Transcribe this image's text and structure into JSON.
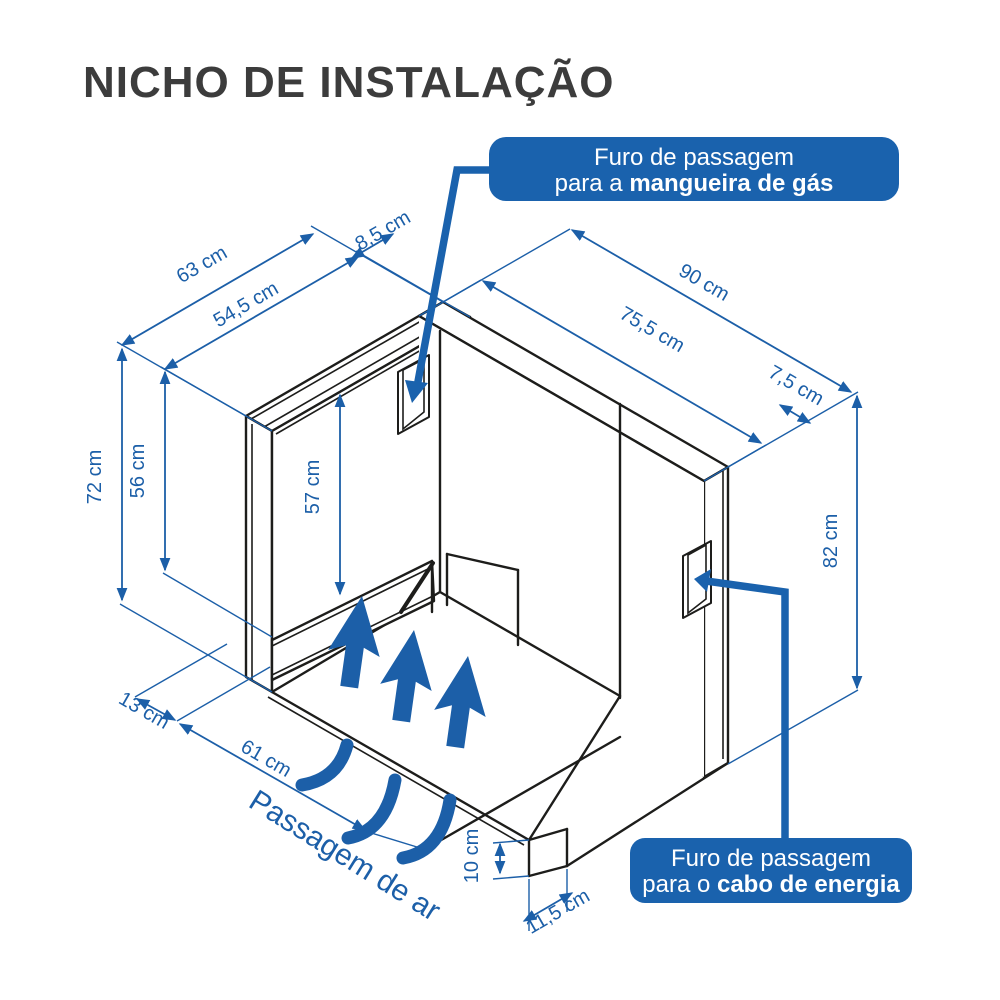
{
  "title": "NICHO DE INSTALAÇÃO",
  "colors": {
    "accent_blue": "#1c5fa8",
    "callout_blue": "#1a62ad",
    "line_black": "#1d1d1b",
    "title_gray": "#3c3c3c",
    "background": "#ffffff"
  },
  "callouts": {
    "gas": {
      "line1": "Furo de passagem",
      "line2_prefix": "para a ",
      "line2_bold": "mangueira de gás"
    },
    "power": {
      "line1": "Furo de passagem",
      "line2_prefix": "para o ",
      "line2_bold": "cabo de energia"
    }
  },
  "air_passage_label": "Passagem de ar",
  "dims": {
    "d63": "63 cm",
    "d545": "54,5 cm",
    "d85": "8,5 cm",
    "d90": "90 cm",
    "d755": "75,5 cm",
    "d75": "7,5 cm",
    "d72": "72 cm",
    "d56": "56 cm",
    "d57": "57 cm",
    "d82": "82 cm",
    "d13": "13 cm",
    "d61": "61 cm",
    "d10": "10 cm",
    "d115": "11,5 cm"
  }
}
